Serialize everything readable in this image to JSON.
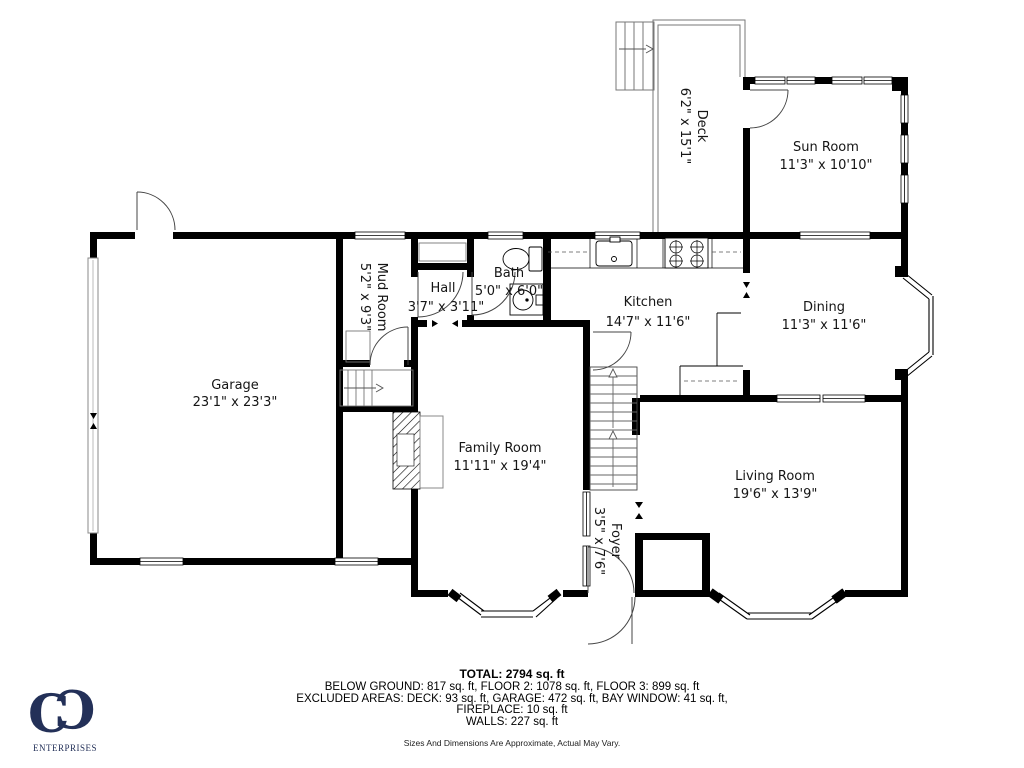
{
  "colors": {
    "walls": "#000000",
    "logo": "#233058"
  },
  "rooms": [
    {
      "name": "Deck",
      "dims": "6'2\" x 15'1\"",
      "rotated": true
    },
    {
      "name": "Sun Room",
      "dims": "11'3\" x 10'10\"",
      "rotated": false
    },
    {
      "name": "Garage",
      "dims": "23'1\" x 23'3\"",
      "rotated": false
    },
    {
      "name": "Mud Room",
      "dims": "5'2\" x 9'3\"",
      "rotated": true
    },
    {
      "name": "Hall",
      "dims": "3'7\" x 3'11\"",
      "rotated": false
    },
    {
      "name": "Bath",
      "dims": "5'0\" x 6'0\"",
      "rotated": false
    },
    {
      "name": "Kitchen",
      "dims": "14'7\" x 11'6\"",
      "rotated": false
    },
    {
      "name": "Dining",
      "dims": "11'3\" x 11'6\"",
      "rotated": false
    },
    {
      "name": "Family Room",
      "dims": "11'11\" x 19'4\"",
      "rotated": false
    },
    {
      "name": "Living Room",
      "dims": "19'6\" x 13'9\"",
      "rotated": false
    },
    {
      "name": "Foyer",
      "dims": "3'5\" x 7'6\"",
      "rotated": true
    }
  ],
  "summary": {
    "total": "TOTAL: 2794 sq. ft",
    "floors": "BELOW GROUND: 817 sq. ft, FLOOR 2: 1078 sq. ft, FLOOR 3: 899 sq. ft",
    "excluded": "EXCLUDED AREAS: DECK: 93 sq. ft, GARAGE: 472 sq. ft, BAY WINDOW: 41 sq. ft,",
    "fireplace": "FIREPLACE: 10 sq. ft",
    "walls": "WALLS: 227 sq. ft",
    "disclaimer": "Sizes And Dimensions Are Approximate, Actual May Vary."
  },
  "logo": {
    "letter_left": "C",
    "letter_right": "C",
    "subtitle": "ENTERPRISES"
  }
}
